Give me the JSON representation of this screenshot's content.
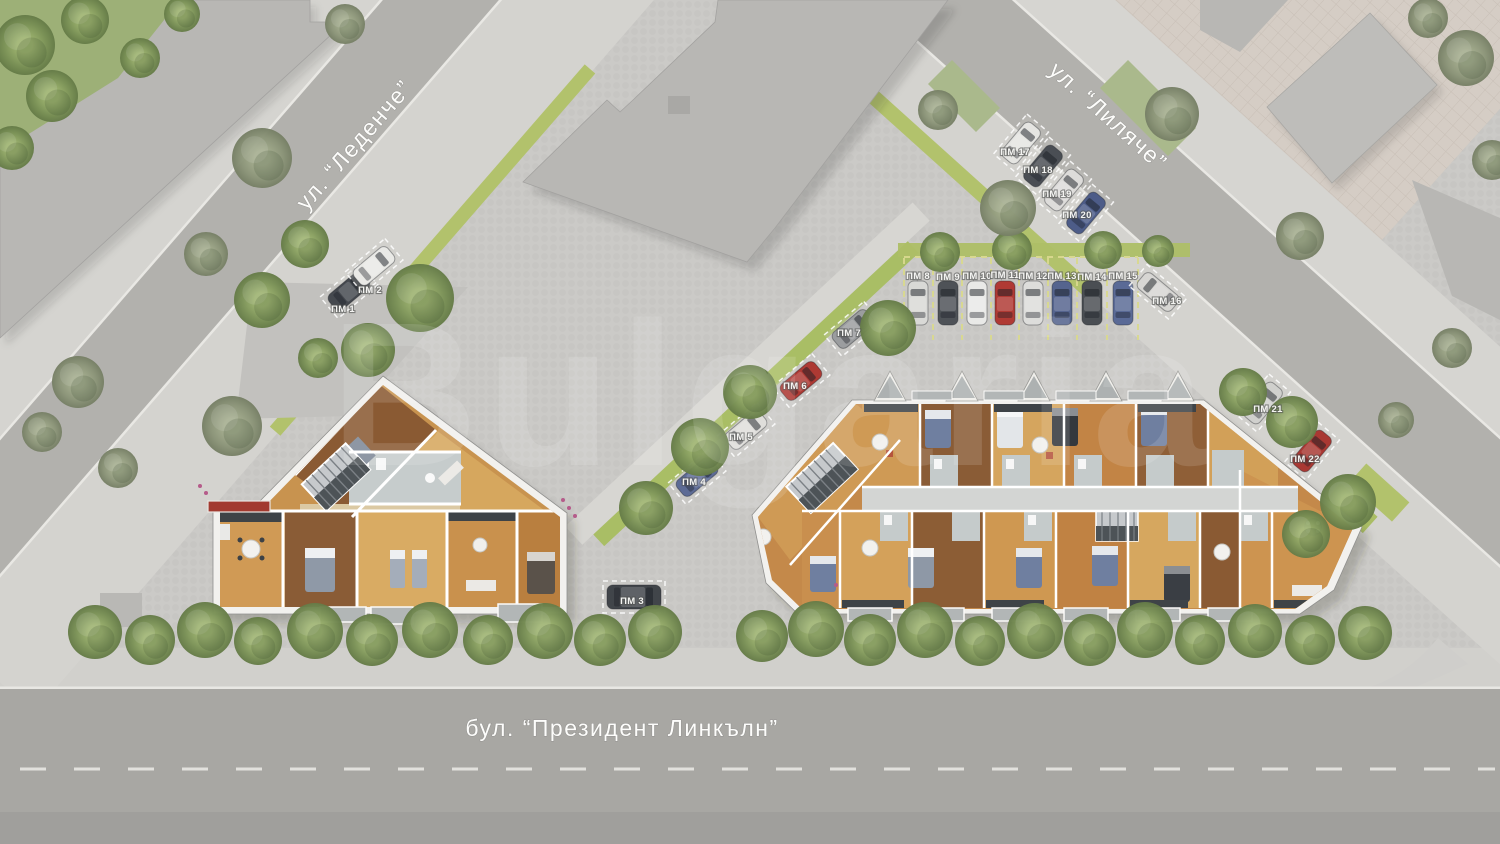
{
  "streets": {
    "ledenche": "ул. “Леденче”",
    "lilyache": "ул. “Лиляче”",
    "lincoln": "бул. “Президент Линкълн”"
  },
  "watermark": "Bulgaria",
  "colors": {
    "pavement": "#cbcac7",
    "road": "#a8a7a3",
    "sidewalk": "#d3d2ce",
    "grass": "#9db077",
    "lime_strip": "#a9be65",
    "building_walls": "#f2f1ee",
    "wood_floor": "#c8934f",
    "gray_building": "#b8b7b4",
    "stall_line": "#d9d98f",
    "label_text": "#f4f4f2"
  },
  "parking": {
    "label_prefix": "ПМ",
    "spots": [
      {
        "label": "ПМ 1",
        "x": 349,
        "y": 291,
        "rot": 50,
        "car": "#45494f",
        "lx": 343,
        "ly": 312
      },
      {
        "label": "ПМ 2",
        "x": 374,
        "y": 266,
        "rot": 50,
        "car": "#e9e9e6",
        "lx": 370,
        "ly": 293
      },
      {
        "label": "ПМ 3",
        "x": 634,
        "y": 597,
        "rot": 90,
        "car": "#41454a",
        "lx": 632,
        "ly": 604,
        "van": true
      },
      {
        "label": "ПМ 4",
        "x": 697,
        "y": 477,
        "rot": 50,
        "car": "#5d6b95",
        "lx": 694,
        "ly": 485
      },
      {
        "label": "ПМ 5",
        "x": 746,
        "y": 430,
        "rot": 50,
        "car": "#dfdedb",
        "lx": 741,
        "ly": 440
      },
      {
        "label": "ПМ 6",
        "x": 801,
        "y": 381,
        "rot": 50,
        "car": "#ad3933",
        "lx": 795,
        "ly": 389
      },
      {
        "label": "ПМ 7",
        "x": 853,
        "y": 329,
        "rot": 50,
        "car": "#9b9d9f",
        "lx": 849,
        "ly": 336
      },
      {
        "label": "ПМ 8",
        "x": 918,
        "y": 303,
        "rot": 0,
        "car": "#d9d9d6",
        "lx": 918,
        "ly": 279,
        "row": true
      },
      {
        "label": "ПМ 9",
        "x": 948,
        "y": 303,
        "rot": 0,
        "car": "#4e5257",
        "lx": 948,
        "ly": 280,
        "row": true
      },
      {
        "label": "ПМ 10",
        "x": 977,
        "y": 303,
        "rot": 0,
        "car": "#e9e9e7",
        "lx": 977,
        "ly": 279,
        "row": true
      },
      {
        "label": "ПМ 11",
        "x": 1005,
        "y": 303,
        "rot": 0,
        "car": "#b03a34",
        "lx": 1005,
        "ly": 278,
        "row": true
      },
      {
        "label": "ПМ 12",
        "x": 1033,
        "y": 303,
        "rot": 0,
        "car": "#dddddb",
        "lx": 1033,
        "ly": 279,
        "row": true
      },
      {
        "label": "ПМ 13",
        "x": 1062,
        "y": 303,
        "rot": 0,
        "car": "#55648e",
        "lx": 1062,
        "ly": 279,
        "row": true
      },
      {
        "label": "ПМ 14",
        "x": 1092,
        "y": 303,
        "rot": 0,
        "car": "#4a4e53",
        "lx": 1092,
        "ly": 280,
        "row": true
      },
      {
        "label": "ПМ 15",
        "x": 1123,
        "y": 303,
        "rot": 0,
        "car": "#5a6a96",
        "lx": 1123,
        "ly": 279,
        "row": true
      },
      {
        "label": "ПМ 16",
        "x": 1158,
        "y": 292,
        "rot": -50,
        "car": "#d7d6d3",
        "lx": 1167,
        "ly": 304
      },
      {
        "label": "ПМ 17",
        "x": 1021,
        "y": 143,
        "rot": 40,
        "car": "#e5e5e2",
        "lx": 1015,
        "ly": 155
      },
      {
        "label": "ПМ 18",
        "x": 1043,
        "y": 166,
        "rot": 40,
        "car": "#4a4e54",
        "lx": 1038,
        "ly": 173
      },
      {
        "label": "ПМ 19",
        "x": 1064,
        "y": 190,
        "rot": 40,
        "car": "#dddcda",
        "lx": 1057,
        "ly": 197
      },
      {
        "label": "ПМ 20",
        "x": 1086,
        "y": 213,
        "rot": 40,
        "car": "#4d5c88",
        "lx": 1077,
        "ly": 218
      },
      {
        "label": "ПМ 21",
        "x": 1263,
        "y": 403,
        "rot": 40,
        "car": "#d0d0cd",
        "lx": 1268,
        "ly": 412
      },
      {
        "label": "ПМ 22",
        "x": 1312,
        "y": 451,
        "rot": 40,
        "car": "#a93833",
        "lx": 1305,
        "ly": 462
      }
    ]
  },
  "scene": {
    "trees": [
      [
        25,
        45,
        30,
        "v"
      ],
      [
        85,
        20,
        24,
        "v"
      ],
      [
        52,
        96,
        26,
        "v"
      ],
      [
        12,
        148,
        22,
        "v"
      ],
      [
        140,
        58,
        20,
        "v"
      ],
      [
        182,
        14,
        18,
        "v"
      ],
      [
        262,
        158,
        30,
        "m"
      ],
      [
        345,
        24,
        20,
        "m"
      ],
      [
        206,
        254,
        22,
        "m"
      ],
      [
        305,
        244,
        24,
        "v"
      ],
      [
        262,
        300,
        28,
        "v"
      ],
      [
        420,
        298,
        34,
        "v"
      ],
      [
        368,
        350,
        27,
        "v"
      ],
      [
        318,
        358,
        20,
        "v"
      ],
      [
        78,
        382,
        26,
        "m"
      ],
      [
        42,
        432,
        20,
        "m"
      ],
      [
        232,
        426,
        30,
        "m"
      ],
      [
        118,
        468,
        20,
        "m"
      ],
      [
        888,
        328,
        28,
        "v"
      ],
      [
        750,
        392,
        27,
        "v"
      ],
      [
        700,
        447,
        29,
        "v"
      ],
      [
        646,
        508,
        27,
        "v"
      ],
      [
        940,
        252,
        20,
        "v"
      ],
      [
        1012,
        250,
        20,
        "v"
      ],
      [
        1103,
        250,
        19,
        "v"
      ],
      [
        1158,
        251,
        16,
        "v"
      ],
      [
        1008,
        208,
        28,
        "m"
      ],
      [
        938,
        110,
        20,
        "m"
      ],
      [
        1172,
        114,
        27,
        "m"
      ],
      [
        1300,
        236,
        24,
        "m"
      ],
      [
        1466,
        58,
        28,
        "m"
      ],
      [
        1492,
        160,
        20,
        "m"
      ],
      [
        1428,
        18,
        20,
        "m"
      ],
      [
        1243,
        392,
        24,
        "v"
      ],
      [
        1292,
        422,
        26,
        "v"
      ],
      [
        1348,
        502,
        28,
        "v"
      ],
      [
        1306,
        534,
        24,
        "v"
      ],
      [
        1396,
        420,
        18,
        "m"
      ],
      [
        1452,
        348,
        20,
        "m"
      ],
      [
        95,
        632,
        27,
        "v"
      ],
      [
        150,
        640,
        25,
        "v"
      ],
      [
        205,
        630,
        28,
        "v"
      ],
      [
        258,
        641,
        24,
        "v"
      ],
      [
        315,
        631,
        28,
        "v"
      ],
      [
        372,
        640,
        26,
        "v"
      ],
      [
        430,
        630,
        28,
        "v"
      ],
      [
        488,
        640,
        25,
        "v"
      ],
      [
        545,
        631,
        28,
        "v"
      ],
      [
        600,
        640,
        26,
        "v"
      ],
      [
        655,
        632,
        27,
        "v"
      ],
      [
        762,
        636,
        26,
        "v"
      ],
      [
        816,
        629,
        28,
        "v"
      ],
      [
        870,
        640,
        26,
        "v"
      ],
      [
        925,
        630,
        28,
        "v"
      ],
      [
        980,
        641,
        25,
        "v"
      ],
      [
        1035,
        631,
        28,
        "v"
      ],
      [
        1090,
        640,
        26,
        "v"
      ],
      [
        1145,
        630,
        28,
        "v"
      ],
      [
        1200,
        640,
        25,
        "v"
      ],
      [
        1255,
        631,
        27,
        "v"
      ],
      [
        1310,
        640,
        25,
        "v"
      ],
      [
        1365,
        633,
        27,
        "v"
      ]
    ]
  }
}
